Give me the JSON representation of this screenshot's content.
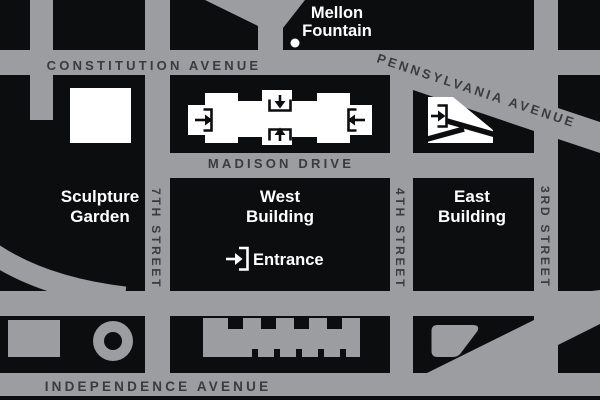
{
  "colors": {
    "road": "#9B9DA0",
    "block": "#0C0D0F",
    "road_label": "#3A3B3E",
    "building": "#FFFFFF"
  },
  "streets": {
    "constitution": "CONSTITUTION AVENUE",
    "pennsylvania": "PENNSYLVANIA AVENUE",
    "madison": "MADISON DRIVE",
    "independence": "INDEPENDENCE AVENUE",
    "seventh": "7TH STREET",
    "fourth": "4TH STREET",
    "third": "3RD STREET"
  },
  "places": {
    "mellon_fountain": {
      "line1": "Mellon",
      "line2": "Fountain"
    },
    "sculpture_garden": {
      "line1": "Sculpture",
      "line2": "Garden"
    },
    "west_building": {
      "line1": "West",
      "line2": "Building"
    },
    "east_building": {
      "line1": "East",
      "line2": "Building"
    },
    "entrance": {
      "label": "Entrance"
    }
  },
  "icons": {
    "entrance_arrow": "arrow-into-doorway-icon",
    "fountain_dot": "fountain-dot-icon",
    "hirshhorn_ring": "ring-building-icon"
  }
}
